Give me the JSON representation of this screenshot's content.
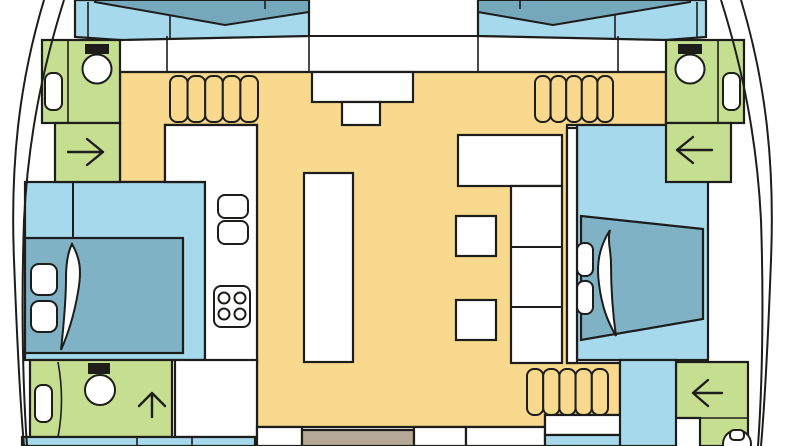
{
  "plan": {
    "kind": "catamaran deck floor plan, bow at top",
    "symbols": {
      "toilets": 4,
      "cabin_sinks": 3,
      "galley_basins": 2,
      "stove_burners": 4,
      "stair_flights": 3,
      "treads_per_flight": 5,
      "companionway_arrows": [
        "right",
        "left",
        "up",
        "left"
      ],
      "double_berths": 2,
      "bow_berths": 2
    }
  },
  "colors": {
    "hull_floor": "#a6d9eb",
    "berth": "#7fb2c5",
    "bow_berth": "#76a8bc",
    "salon": "#f8d98d",
    "bathroom": "#c6de8f",
    "deck": "#ffffff",
    "doormat": "#b5a897",
    "outline": "#1d1d1b"
  }
}
